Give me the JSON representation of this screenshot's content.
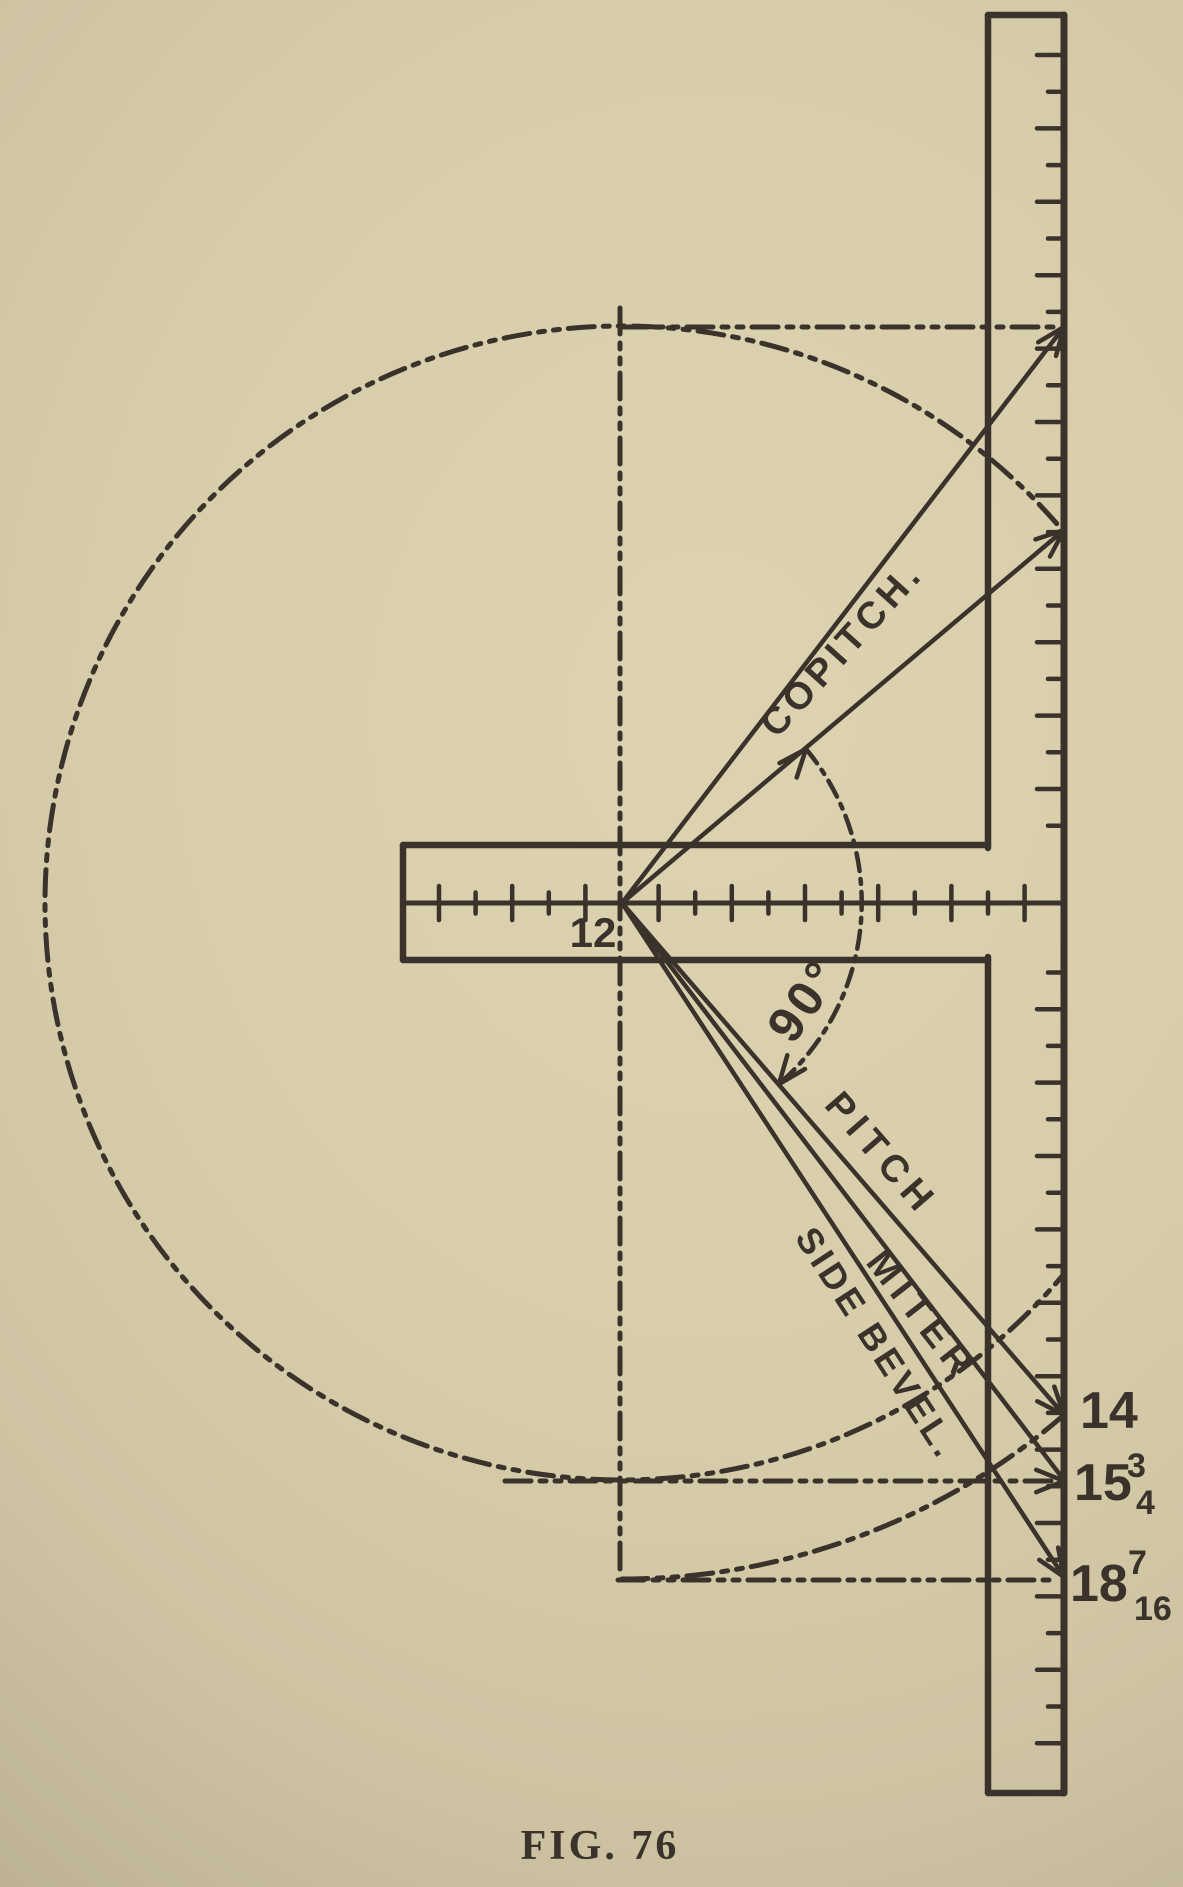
{
  "figure": {
    "caption": "FIG. 76",
    "ink_color": "#3a322b",
    "paper_color_light": "#ddd3b1",
    "paper_color_dark": "#a2977f",
    "center": {
      "x": 622,
      "y": 903
    },
    "square": {
      "blade": {
        "left": 988,
        "right": 1064,
        "top": 15,
        "bottom": 1793,
        "tick_start": 55,
        "tick_step": 36.7,
        "tick_end": 1762,
        "tick_long": 27,
        "tick_short": 16,
        "gap_top": 848,
        "gap_bottom": 957
      },
      "tongue": {
        "left": 403,
        "top": 845,
        "bottom": 960,
        "center_y": 903,
        "right": 988,
        "scale_end": 1064,
        "tick_start": 439,
        "tick_step": 36.6,
        "tick_end": 1058,
        "tick_long": 34,
        "tick_short": 21
      },
      "run_label": {
        "text": "12",
        "x": 593,
        "y": 947
      }
    },
    "rays": [
      {
        "name": "copitch-upper-line",
        "x": 1064,
        "y": 327
      },
      {
        "name": "copitch-lower-line",
        "x": 1064,
        "y": 530
      },
      {
        "name": "pitch-line",
        "x": 1064,
        "y": 1415
      },
      {
        "name": "miter-line",
        "x": 1064,
        "y": 1480
      },
      {
        "name": "side-bevel-line",
        "x": 1064,
        "y": 1577
      }
    ],
    "dash_lines": [
      {
        "name": "vertical-center-dash-line",
        "x1": 620,
        "y1": 308,
        "x2": 620,
        "y2": 1578
      },
      {
        "name": "top-tangent-dash-line",
        "x1": 622,
        "y1": 327,
        "x2": 1058,
        "y2": 327
      },
      {
        "name": "copitch-length-dash-line",
        "x1": 505,
        "y1": 1481,
        "x2": 1052,
        "y2": 1481
      },
      {
        "name": "rafter-length-dash-line",
        "x1": 618,
        "y1": 1580,
        "x2": 1056,
        "y2": 1580
      }
    ],
    "circle": {
      "cx": 622,
      "cy": 903,
      "r": 577,
      "clip_right": 1064
    },
    "swing_arc": {
      "r": 676,
      "x1": 622,
      "y1": 1579,
      "x2": 1064,
      "y2": 1415
    },
    "angle_arc": {
      "r": 240,
      "x1": 806,
      "y1": 749,
      "x2": 779,
      "y2": 1084
    },
    "arrows": [
      {
        "name": "copitch-upper-arrow",
        "x": 1064,
        "y": 327,
        "angle": -52.5
      },
      {
        "name": "copitch-lower-arrow",
        "x": 1064,
        "y": 530,
        "angle": -40.2
      },
      {
        "name": "pitch-arrow",
        "x": 1064,
        "y": 1415,
        "angle": 49.2
      },
      {
        "name": "miter-arrow",
        "x": 1064,
        "y": 1481,
        "angle": 0
      },
      {
        "name": "side-bevel-arrow",
        "x": 1064,
        "y": 1577,
        "angle": 56.7
      },
      {
        "name": "angle-arc-top-arrow",
        "x": 806,
        "y": 749,
        "angle": -50
      },
      {
        "name": "angle-arc-bottom-arrow",
        "x": 779,
        "y": 1084,
        "angle": 128
      }
    ],
    "labels": [
      {
        "name": "copitch-label",
        "text": "COPITCH.",
        "x": 851,
        "y": 657,
        "rot": -48,
        "size": 38,
        "ls": 5
      },
      {
        "name": "ninety-degree-label",
        "text": "90°",
        "x": 818,
        "y": 1010,
        "rot": -55,
        "size": 50,
        "ls": 4
      },
      {
        "name": "pitch-label",
        "text": "PITCH",
        "x": 872,
        "y": 1162,
        "rot": 49,
        "size": 38,
        "ls": 7
      },
      {
        "name": "miter-label",
        "text": "MITER",
        "x": 912,
        "y": 1323,
        "rot": 52,
        "size": 38,
        "ls": 7
      },
      {
        "name": "side-bevel-label",
        "text": "SIDE BEVEL.",
        "x": 867,
        "y": 1350,
        "rot": 57,
        "size": 36,
        "ls": 4
      }
    ],
    "measurements": [
      {
        "name": "pitch-value",
        "text": "14",
        "x": 1080,
        "y": 1428,
        "size": 52
      },
      {
        "name": "miter-value",
        "text": "15",
        "x": 1074,
        "y": 1500,
        "size": 52,
        "num": {
          "text": "3",
          "x": 1127,
          "y": 1477
        },
        "den": {
          "text": "4",
          "x": 1136,
          "y": 1514
        }
      },
      {
        "name": "side-bevel-value",
        "text": "18",
        "x": 1070,
        "y": 1601,
        "size": 52,
        "num": {
          "text": "7",
          "x": 1128,
          "y": 1574
        },
        "den": {
          "text": "16",
          "x": 1134,
          "y": 1620
        }
      }
    ]
  }
}
